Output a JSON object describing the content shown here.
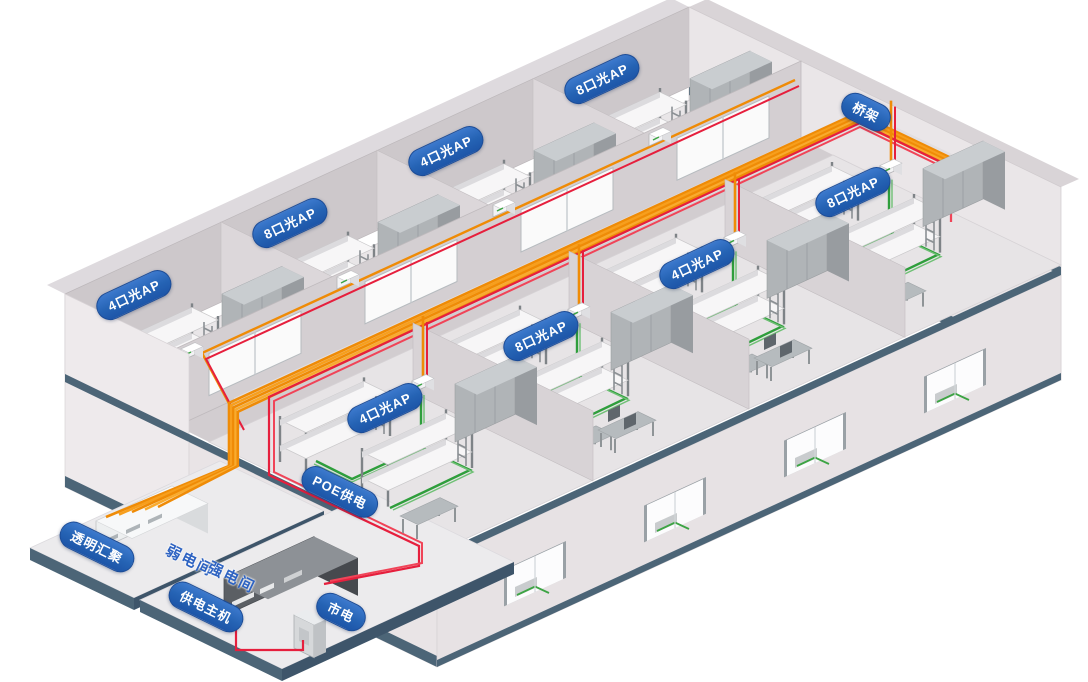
{
  "diagram": {
    "description": "isometric dormitory building optical-AP network cabling diagram",
    "labels": {
      "back_ap_1": "4口光AP",
      "back_ap_2": "8口光AP",
      "back_ap_3": "4口光AP",
      "back_ap_4": "8口光AP",
      "front_ap_1": "4口光AP",
      "front_ap_2": "8口光AP",
      "front_ap_3": "4口光AP",
      "front_ap_4": "8口光AP",
      "bridge": "桥架",
      "poe": "POE供电",
      "aggregation": "透明汇聚",
      "weak_room": "弱电间",
      "strong_room": "强电间",
      "power_host": "供电主机",
      "mains": "市电"
    },
    "colors": {
      "fiber_orange": "#ef8b06",
      "power_red": "#e61f3d",
      "lan_green": "#2f9e3c",
      "label_blue": "#2563b4",
      "slab_slate": "#4c6577",
      "wall_gray": "#d4cfd2",
      "background": "#ffffff"
    },
    "structure": {
      "upper_floor_back_rooms": 4,
      "upper_floor_front_rooms": 4,
      "facade_windows": 4,
      "platforms": 2
    }
  }
}
